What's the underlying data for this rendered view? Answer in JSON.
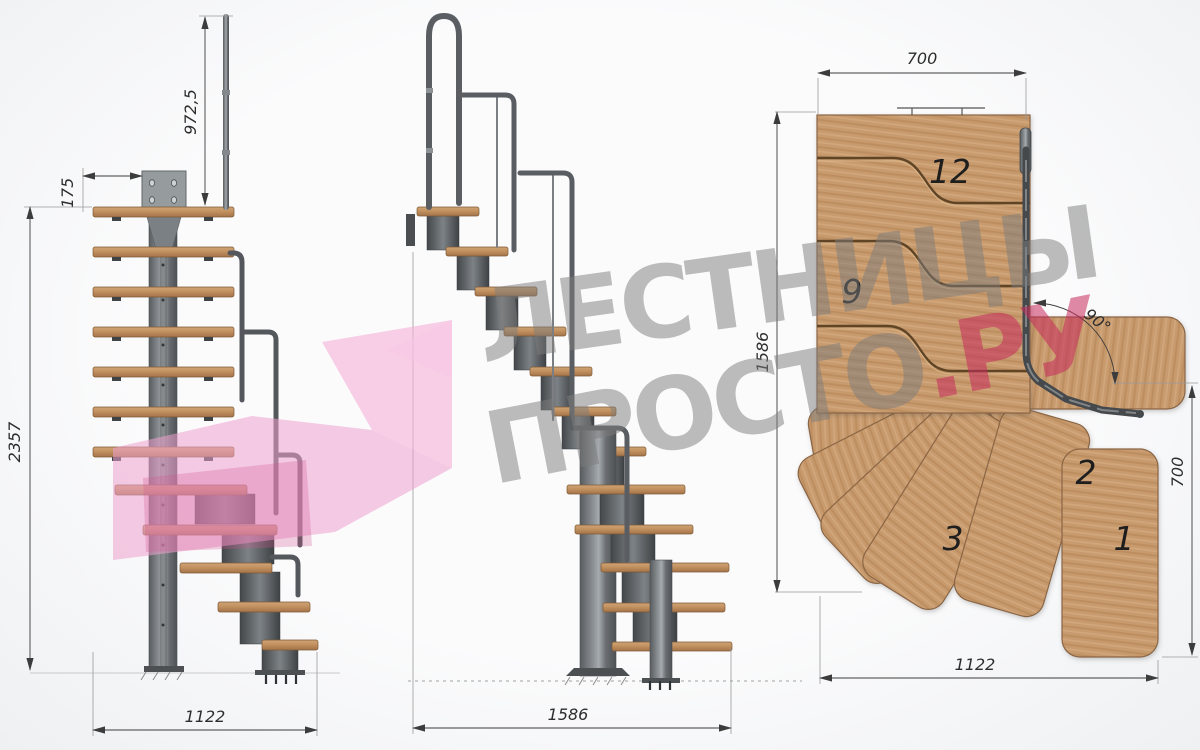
{
  "watermark": {
    "line1": "ЛЕСТНИЦЫ",
    "line2_gray": "ПРОСТО",
    "line2_pink": ".РУ"
  },
  "views": {
    "left_elevation": {
      "dims": {
        "rail_height": "972,5",
        "plate_offset": "175",
        "total_height": "2357",
        "footprint_width": "1122"
      }
    },
    "side_elevation": {
      "dims": {
        "total_run": "1586"
      }
    },
    "plan": {
      "dims": {
        "top_width": "700",
        "left_depth": "1586",
        "turn_angle": "90°",
        "right_depth": "700",
        "bottom_width": "1122"
      },
      "steps": {
        "s12": "12",
        "s9": "9",
        "s3": "3",
        "s2": "2",
        "s1": "1"
      }
    }
  },
  "colors": {
    "wood": "#c89b6e",
    "wood_outline": "#8a6544",
    "metal": "#5a5e62",
    "dim_line": "#3c3c3c",
    "watermark_gray": "#7c7c7c",
    "watermark_pink": "#c72a5c",
    "arrow_pink": "#f0a5d2"
  }
}
